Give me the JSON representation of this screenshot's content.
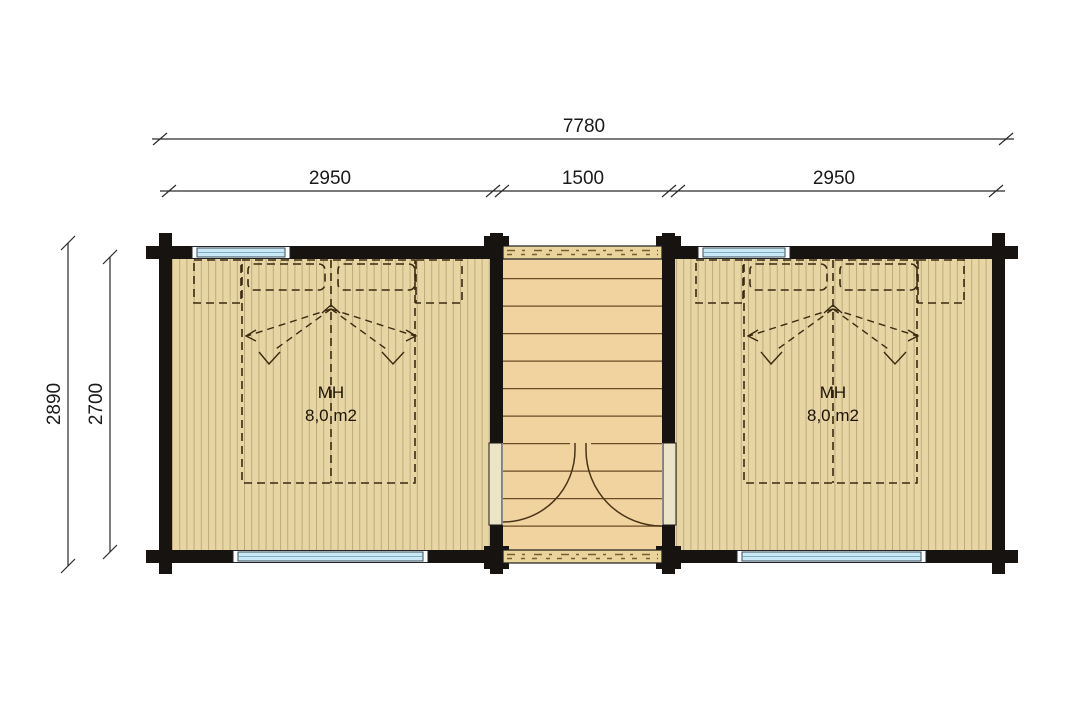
{
  "plan": {
    "dim_total_width": "7780",
    "dim_segments": [
      "2950",
      "1500",
      "2950"
    ],
    "dim_outer_depth": "2890",
    "dim_inner_depth": "2700",
    "room_left": {
      "label": "MH",
      "area": "8,0 m2"
    },
    "room_right": {
      "label": "MH",
      "area": "8,0 m2"
    },
    "colors": {
      "wall": "#171310",
      "room_floor": "#e7d5a4",
      "room_plank_line": "#bfab7c",
      "porch_floor": "#f1d3a0",
      "porch_plank_line": "#6b4b26",
      "wood_strip": "#e9d49c",
      "door_leaf": "#ece4c6",
      "window_glass": "#c9e9f7",
      "bed_dash": "#3a2a10",
      "dimension_line": "#2a2a2a"
    }
  }
}
